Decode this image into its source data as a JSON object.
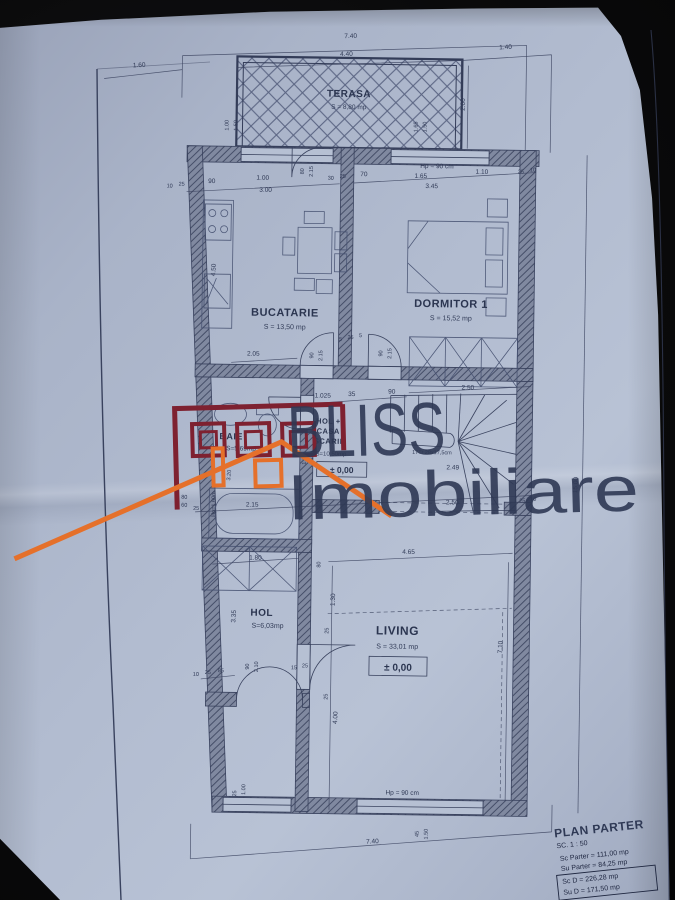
{
  "photo": {
    "background": "#0a0a0b",
    "paper_tint": "#aeb8cc",
    "ink": "#2f3955"
  },
  "watermark": {
    "brand_top": "BLISS",
    "brand_bottom": "Imobiliare",
    "logo_red": "#7e2130",
    "logo_orange": "#e5702a"
  },
  "title_block": {
    "title": "PLAN PARTER",
    "scale": "SC. 1 : 50",
    "sc_parter": "Sc Parter = 111,00 mp",
    "su_parter": "Su Parter = 84,25 mp",
    "sc_d": "Sc D = 226,28 mp",
    "su_d": "Su D = 171,50 mp"
  },
  "rooms": {
    "terasa": {
      "name": "TERASA",
      "area": "S = 8,80 mp"
    },
    "bucatarie": {
      "name": "BUCATARIE",
      "area": "S = 13,50 mp"
    },
    "dormitor": {
      "name": "DORMITOR 1",
      "area": "S = 15,52 mp"
    },
    "hol_casa": {
      "line1": "HOL +",
      "line2": "CASA",
      "line3": "SCARII",
      "area": "S=10,50mp",
      "level": "± 0,00"
    },
    "baie": {
      "name": "BAIE",
      "area": "S=5,69mp"
    },
    "hol": {
      "name": "HOL",
      "area": "S=6,03mp"
    },
    "living": {
      "name": "LIVING",
      "area": "S = 33,01 mp",
      "level": "± 0,00"
    }
  },
  "dims": {
    "t740": "7.40",
    "t160": "1.60",
    "t440": "4.40",
    "t140": "1.40",
    "t200": "2.00",
    "tw100": "1.00",
    "tw150": "1.50",
    "tr165": "1.65",
    "tr150": "1.50",
    "k10": "10",
    "k25": "25",
    "k90": "90",
    "k100": "1.00",
    "k300": "3.00",
    "kd80": "80",
    "kd215": "2.15",
    "k30": "30",
    "k25b": "25",
    "k70": "70",
    "dhp": "Hp = 90 cm",
    "d165": "1.65",
    "d110": "1.10",
    "d345": "3.45",
    "d25": "25",
    "d10": "10",
    "l450": "4.50",
    "k205": "2.05",
    "mda90": "90",
    "mda215": "2.15",
    "md5a": "5",
    "md25": "25",
    "md5b": "5",
    "mdb90": "90",
    "mdb215": "2.15",
    "b1025": "1.025",
    "b35": "35",
    "b90": "90",
    "s250t": "2.50",
    "streads": "17Tr 28x17,5cm",
    "s249": "2.49",
    "ba115": "1.15",
    "ba320": "3.20",
    "bahp": "Hp=1,60m",
    "ba80": "80",
    "ba60": "60",
    "m25a": "25",
    "m215": "2.15",
    "m250": "2.50",
    "m25b": "25",
    "m10": "10",
    "r15": "15.00",
    "c180": "1.80",
    "c80": "80",
    "h335": "3.35",
    "hd90": "90",
    "hd210": "2.10",
    "h10": "10",
    "h25": "25",
    "h85": "85",
    "h15": "15",
    "h25b": "25",
    "lv465": "4.65",
    "lv130": "1.30",
    "lv710": "7.10",
    "lv400": "4.00",
    "lv25a": "25",
    "lv25b": "25",
    "bhp": "Hp = 90 cm",
    "bw45": "45",
    "bw150": "1.50",
    "b740": "7.40",
    "blw100": "1.00",
    "blw25": "25"
  }
}
